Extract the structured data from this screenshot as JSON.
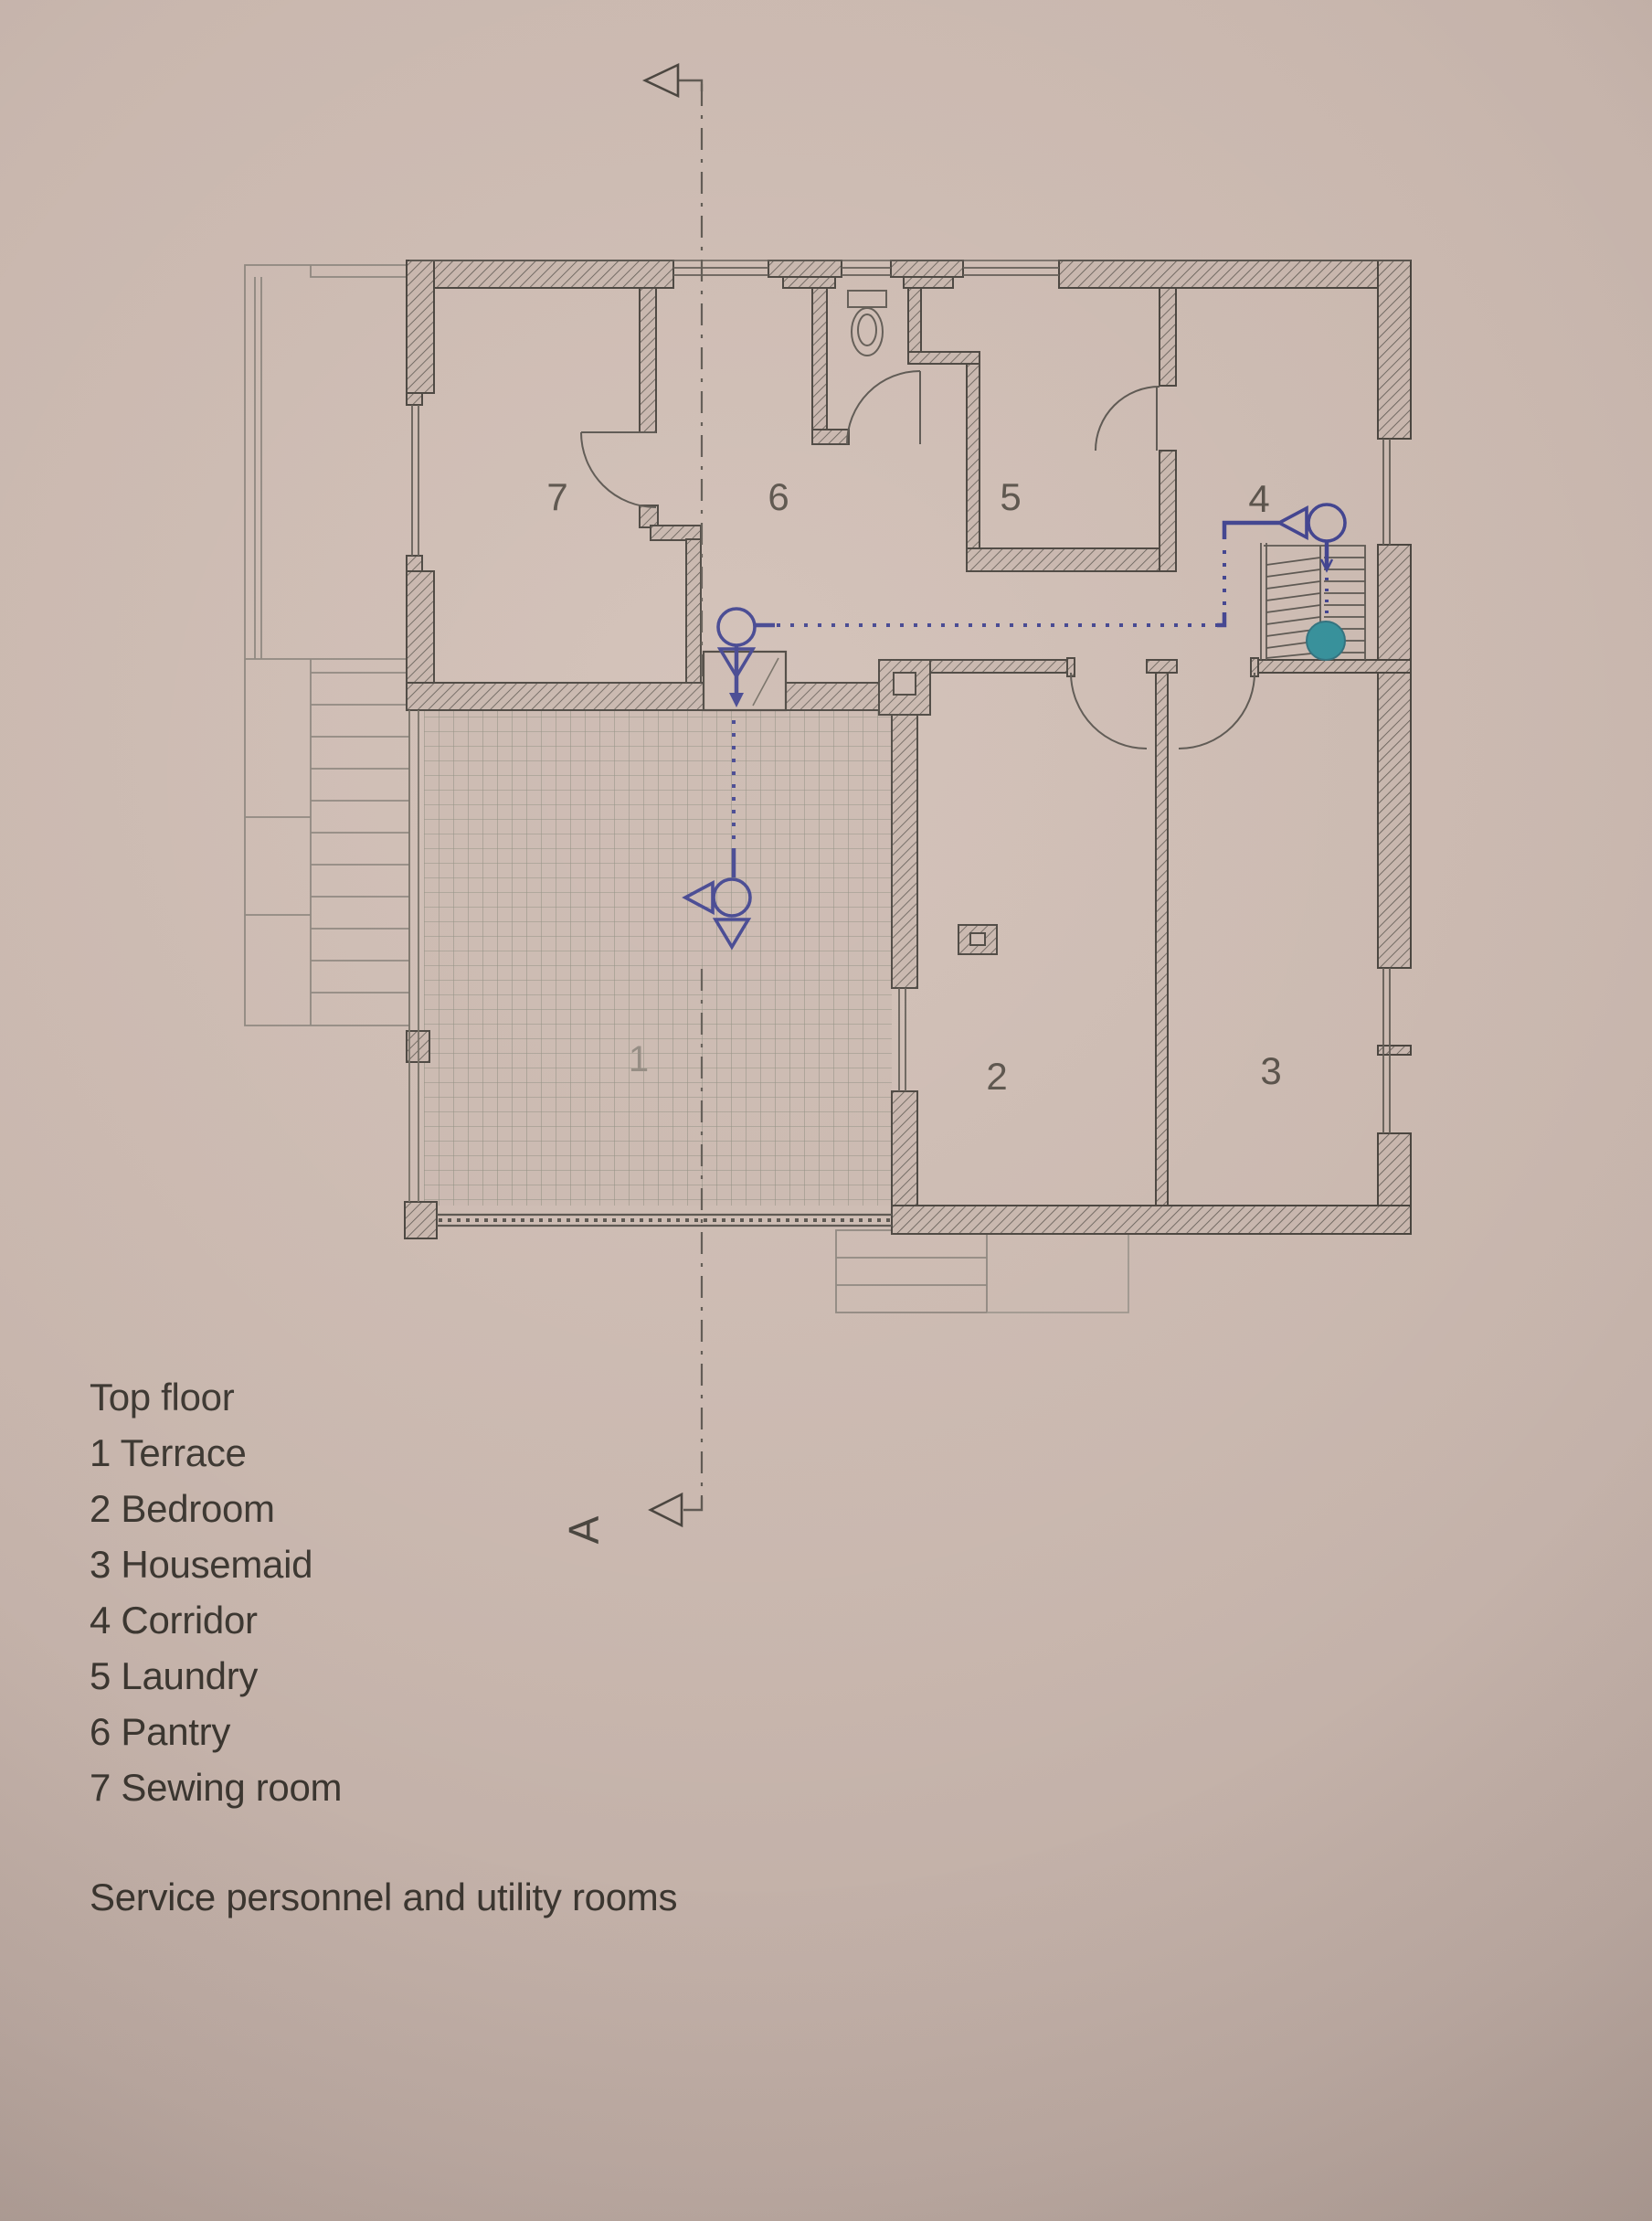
{
  "page": {
    "background_color": "#c8b6ad",
    "ink_color": "#45403a"
  },
  "plan": {
    "section_letter": "A",
    "annotation_colors": {
      "camera_blue": "#3b3e8c",
      "stair_dot_teal": "#2f8c97",
      "section_line_gray": "#5b554e"
    },
    "rooms": [
      {
        "number": "1",
        "name": "Terrace"
      },
      {
        "number": "2",
        "name": "Bedroom"
      },
      {
        "number": "3",
        "name": "Housemaid"
      },
      {
        "number": "4",
        "name": "Corridor"
      },
      {
        "number": "5",
        "name": "Laundry"
      },
      {
        "number": "6",
        "name": "Pantry"
      },
      {
        "number": "7",
        "name": "Sewing room"
      }
    ],
    "icons": {
      "toilet": "toilet-plan-symbol",
      "camera_marker": "circle-with-triangle-pointer",
      "stair_dot": "filled-teal-circle"
    }
  },
  "legend": {
    "title": "Top floor",
    "items": [
      "1 Terrace",
      "2 Bedroom",
      "3 Housemaid",
      "4 Corridor",
      "5 Laundry",
      "6 Pantry",
      "7 Sewing room"
    ],
    "caption": "Service personnel and utility rooms"
  }
}
